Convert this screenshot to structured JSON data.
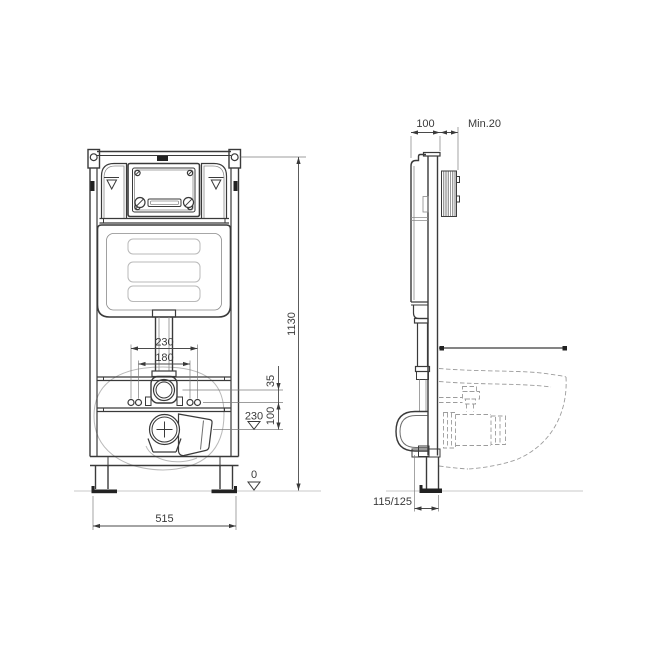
{
  "colors": {
    "line": "#3a3a3a",
    "thin_line": "#8a8a8a",
    "light_line": "#b9b9b9",
    "dashed_line": "#9c9c9c",
    "floor_line": "#c9c9c9",
    "text": "#3a3a3a",
    "background": "#ffffff"
  },
  "front": {
    "height": "1130",
    "width": "515",
    "outer_bolts": "230",
    "inner_bolts": "180",
    "inlet_gap": "35",
    "bolt_height": "100",
    "outlet_level": "230",
    "floor_level": "0"
  },
  "side": {
    "depth": "100",
    "wall_min": "Min.20",
    "outlet_axis": "115/125"
  }
}
